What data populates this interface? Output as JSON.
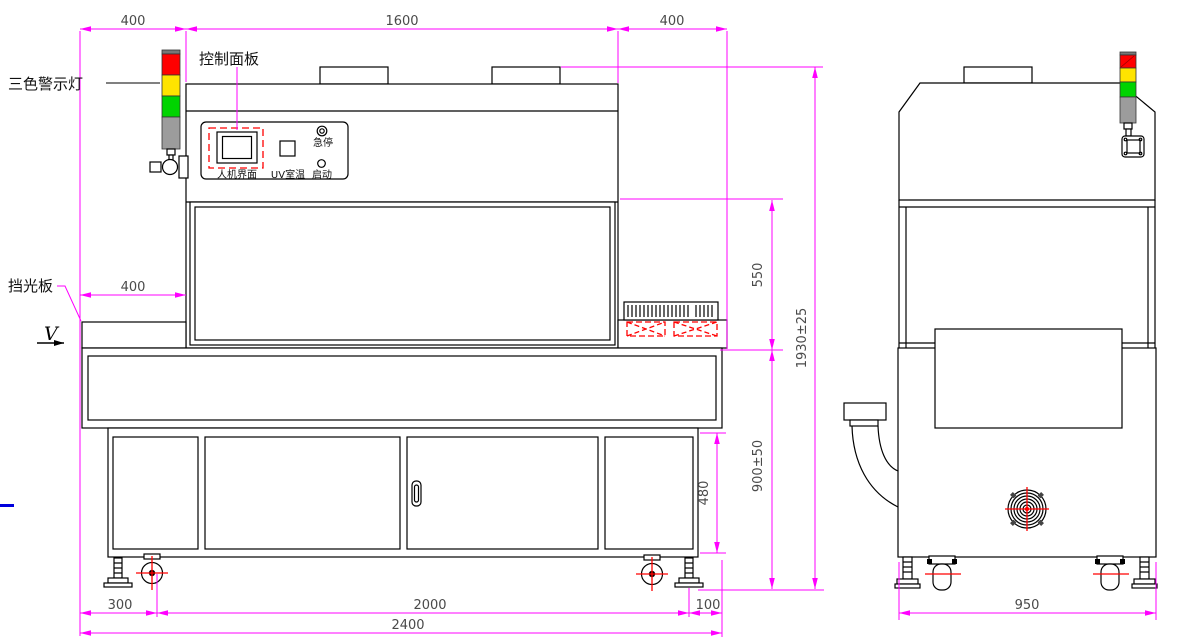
{
  "drawing": {
    "labels": {
      "tri_color_warning_light": "三色警示灯",
      "control_panel": "控制面板",
      "light_shield": "挡光板",
      "view_marker": "V"
    },
    "panel": {
      "hmi": "人机界面",
      "uv_temp": "UV室温",
      "estop": "急停",
      "start": "启动"
    },
    "dims": {
      "top_left": "400",
      "top_center": "1600",
      "top_right": "400",
      "mid_left": "400",
      "chamber_height": "550",
      "overall_height": "1930±25",
      "cabinet_height": "480",
      "table_height": "900±50",
      "bottom_offset_left": "300",
      "bottom_center": "2000",
      "bottom_offset_right": "100",
      "bottom_total": "2400",
      "side_width": "950"
    },
    "colors": {
      "dimension_magenta": "#FF00FF",
      "alert_red": "#FF0000",
      "tower_red": "#FF0000",
      "tower_yellow": "#FFE400",
      "tower_green": "#00D400",
      "tower_gray": "#9C9C9C",
      "accent_blue": "#0000DD"
    }
  }
}
